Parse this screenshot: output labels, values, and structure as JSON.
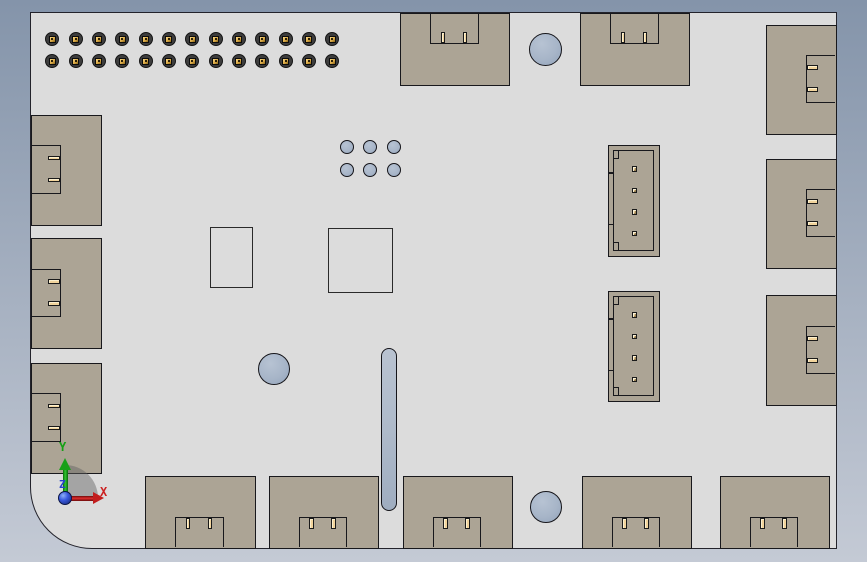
{
  "axis_triad": {
    "x_label": "X",
    "y_label": "Y",
    "z_label": "Z"
  },
  "colors": {
    "background_top": "#8494aa",
    "background_bottom": "#c4cad5",
    "board_fill": "#dcdcdc",
    "edge_line": "#18181c",
    "connector_body": "#aca495",
    "pin_contact": "#f2d49c",
    "hole_fill": "#a7b5c8",
    "axis_x": "#cc2020",
    "axis_y": "#14a014",
    "axis_z": "#2840cc"
  },
  "board": {
    "x": 30,
    "y": 12,
    "width": 807,
    "height": 537,
    "corner_radius_bottom_left": 62
  },
  "edge_notch": {
    "span": 48.5,
    "depth_tb": 30,
    "depth_lr": 29
  },
  "edge_pin": {
    "long": 11.5,
    "short": 4.5,
    "offset": 10.8
  },
  "jst_spec": {
    "inner_inset": 5.5,
    "pin_size": 5.5,
    "pin_cx": 26.8,
    "pin_cy_offsets": [
      24.5,
      46,
      67.5,
      89
    ],
    "tick_y_offsets": [
      28.5,
      80
    ]
  },
  "components": [
    {
      "type": "pin_header",
      "name": "header-pin-grid",
      "cx0": 52.3,
      "cy0": 39,
      "cols": 13,
      "col_pitch": 23.33,
      "rows": 2,
      "row_pitch": 22.3,
      "pin_d": 14
    },
    {
      "type": "via_grid",
      "name": "via-grid",
      "cx0": 346.5,
      "cy0": 147,
      "cols": 3,
      "col_pitch": 23.5,
      "rows": 2,
      "row_pitch": 23,
      "d": 14
    },
    {
      "type": "hole",
      "name": "mounting-hole-top",
      "cx": 545,
      "cy": 49.5,
      "d": 33
    },
    {
      "type": "hole",
      "name": "mounting-hole-middle",
      "cx": 273.5,
      "cy": 368.5,
      "d": 32
    },
    {
      "type": "hole",
      "name": "mounting-hole-bottom",
      "cx": 545.5,
      "cy": 506.5,
      "d": 32
    },
    {
      "type": "slot",
      "name": "board-slot",
      "x": 380.5,
      "y": 347.5,
      "w": 16,
      "h": 163
    },
    {
      "type": "outline",
      "name": "ic-outline-small",
      "x": 209.5,
      "y": 226.5,
      "w": 43,
      "h": 61
    },
    {
      "type": "outline",
      "name": "ic-outline-large",
      "x": 328,
      "y": 228,
      "w": 65,
      "h": 65
    },
    {
      "type": "edge_connector",
      "side": "top",
      "name": "top-connector-1",
      "x": 400,
      "y": 13,
      "w": 110,
      "h": 73
    },
    {
      "type": "edge_connector",
      "side": "top",
      "name": "top-connector-2",
      "x": 580,
      "y": 13,
      "w": 110,
      "h": 73
    },
    {
      "type": "edge_connector",
      "side": "right",
      "name": "right-connector-1",
      "x": 765.5,
      "y": 24.5,
      "w": 71,
      "h": 110
    },
    {
      "type": "edge_connector",
      "side": "right",
      "name": "right-connector-2",
      "x": 765.5,
      "y": 158.5,
      "w": 71,
      "h": 110
    },
    {
      "type": "edge_connector",
      "side": "right",
      "name": "right-connector-3",
      "x": 765.5,
      "y": 295,
      "w": 71,
      "h": 111
    },
    {
      "type": "edge_connector",
      "side": "left",
      "name": "left-connector-1",
      "x": 30.5,
      "y": 114.5,
      "w": 71,
      "h": 111
    },
    {
      "type": "edge_connector",
      "side": "left",
      "name": "left-connector-2",
      "x": 30.5,
      "y": 238,
      "w": 71,
      "h": 111
    },
    {
      "type": "edge_connector",
      "side": "left",
      "name": "left-connector-3",
      "x": 30.5,
      "y": 362.5,
      "w": 71,
      "h": 111
    },
    {
      "type": "jst_connector",
      "name": "jst-connector-1",
      "x": 608,
      "y": 145,
      "w": 52,
      "h": 112
    },
    {
      "type": "jst_connector",
      "name": "jst-connector-2",
      "x": 608,
      "y": 291,
      "w": 52,
      "h": 111
    },
    {
      "type": "edge_connector",
      "side": "bottom",
      "name": "bottom-connector-1",
      "x": 144.5,
      "y": 475.5,
      "w": 111,
      "h": 73
    },
    {
      "type": "edge_connector",
      "side": "bottom",
      "name": "bottom-connector-2",
      "x": 268.5,
      "y": 475.5,
      "w": 110,
      "h": 73
    },
    {
      "type": "edge_connector",
      "side": "bottom",
      "name": "bottom-connector-3",
      "x": 402.5,
      "y": 475.5,
      "w": 110,
      "h": 73
    },
    {
      "type": "edge_connector",
      "side": "bottom",
      "name": "bottom-connector-4",
      "x": 581.5,
      "y": 475.5,
      "w": 110,
      "h": 73
    },
    {
      "type": "edge_connector",
      "side": "bottom",
      "name": "bottom-connector-5",
      "x": 719.5,
      "y": 475.5,
      "w": 110,
      "h": 73
    }
  ]
}
